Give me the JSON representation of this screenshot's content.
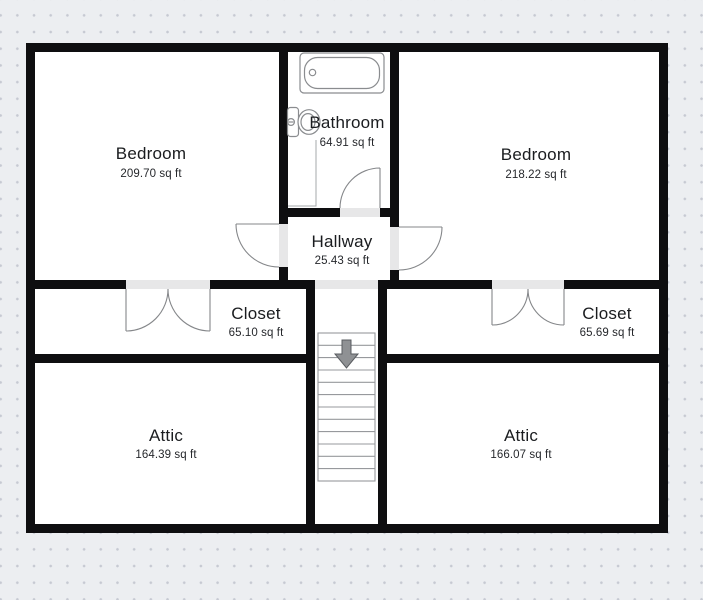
{
  "floor_plan": {
    "rooms": [
      {
        "id": "bedroom-left",
        "name": "Bedroom",
        "area": "209.70 sq ft"
      },
      {
        "id": "bathroom",
        "name": "Bathroom",
        "area": "64.91 sq ft"
      },
      {
        "id": "bedroom-right",
        "name": "Bedroom",
        "area": "218.22 sq ft"
      },
      {
        "id": "hallway",
        "name": "Hallway",
        "area": "25.43 sq ft"
      },
      {
        "id": "closet-left",
        "name": "Closet",
        "area": "65.10 sq ft"
      },
      {
        "id": "closet-right",
        "name": "Closet",
        "area": "65.69 sq ft"
      },
      {
        "id": "attic-left",
        "name": "Attic",
        "area": "164.39 sq ft"
      },
      {
        "id": "attic-right",
        "name": "Attic",
        "area": "166.07 sq ft"
      }
    ],
    "fixtures": [
      {
        "id": "bathtub",
        "room": "bathroom"
      },
      {
        "id": "toilet",
        "room": "bathroom"
      },
      {
        "id": "staircase",
        "direction": "down",
        "steps": 12
      }
    ],
    "doors": [
      "bathroom-door",
      "bedroom-left-door",
      "bedroom-right-door",
      "closet-left-double-door",
      "closet-right-double-door",
      "stair-opening"
    ],
    "colors": {
      "wall": "#0e0e10",
      "room_fill": "#ffffff",
      "background": "#eceef1",
      "dot_grid": "#c6c9d2",
      "door_opening": "#e7e7e8",
      "fixture_stroke": "#8a8c8f",
      "stair_arrow": "#8f9194",
      "text": "#1a1c1f"
    }
  }
}
